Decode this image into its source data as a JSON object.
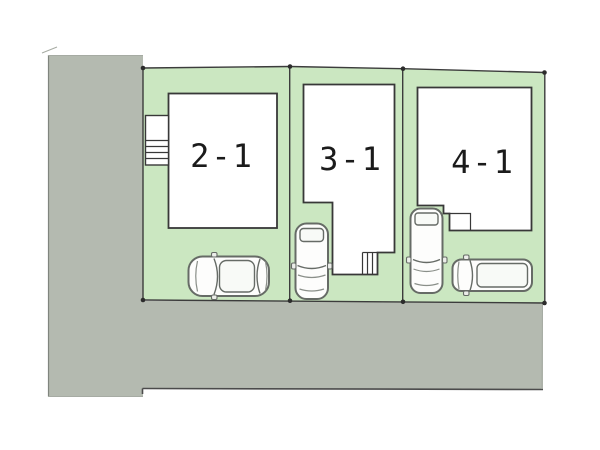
{
  "page": {
    "type": "real-estate-site-plan",
    "background": "#ffffff"
  },
  "colors": {
    "page_background": "#ffffff",
    "lot_green": "#cbe7c1",
    "road_gray": "#b4bab0",
    "boundary_line": "#3c3c3c",
    "house_outline": "#383838",
    "house_fill": "#ffffff",
    "car_outline": "#666b66",
    "label_color": "#1b1b1b"
  },
  "road": {
    "shape": "L-shaped",
    "position": "left-and-bottom"
  },
  "lots": [
    {
      "label": "2-1",
      "house": "rectangular-house-with-entrance-steps",
      "parked_vehicles": [
        "sedan"
      ]
    },
    {
      "label": "3-1",
      "house": "l-shaped-house-with-steps",
      "parked_vehicles": [
        "sedan"
      ]
    },
    {
      "label": "4-1",
      "house": "l-shaped-house-with-porch",
      "parked_vehicles": [
        "wagon",
        "van"
      ]
    }
  ]
}
